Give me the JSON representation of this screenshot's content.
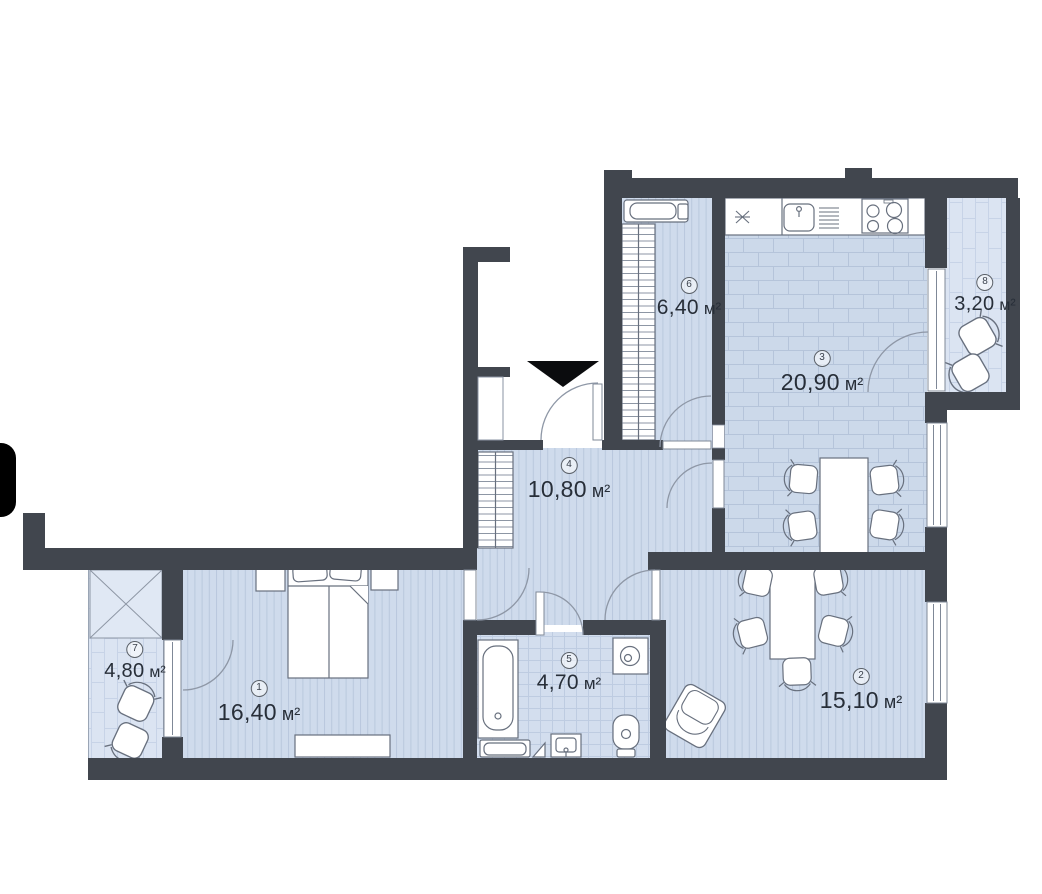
{
  "plan": {
    "type": "apartment-floor-plan",
    "rooms": [
      {
        "number": "1",
        "area": "16,40",
        "unit": "м²"
      },
      {
        "number": "2",
        "area": "15,10",
        "unit": "м²"
      },
      {
        "number": "3",
        "area": "20,90",
        "unit": "м²"
      },
      {
        "number": "4",
        "area": "10,80",
        "unit": "м²"
      },
      {
        "number": "5",
        "area": "4,70",
        "unit": "м²"
      },
      {
        "number": "6",
        "area": "6,40",
        "unit": "м²"
      },
      {
        "number": "7",
        "area": "4,80",
        "unit": "м²"
      },
      {
        "number": "8",
        "area": "3,20",
        "unit": "м²"
      }
    ],
    "colors": {
      "wall": "#41464e",
      "floor": "#cfdbec",
      "floor_line": "#b9c8dd",
      "balcony_floor": "#dbe4f2",
      "bath_floor": "#d3deee",
      "furniture_stroke": "#68707e",
      "door_arc": "#8e97a6",
      "label_text": "#272e38"
    },
    "icons": {
      "entrance": "entrance-arrow-icon"
    }
  }
}
